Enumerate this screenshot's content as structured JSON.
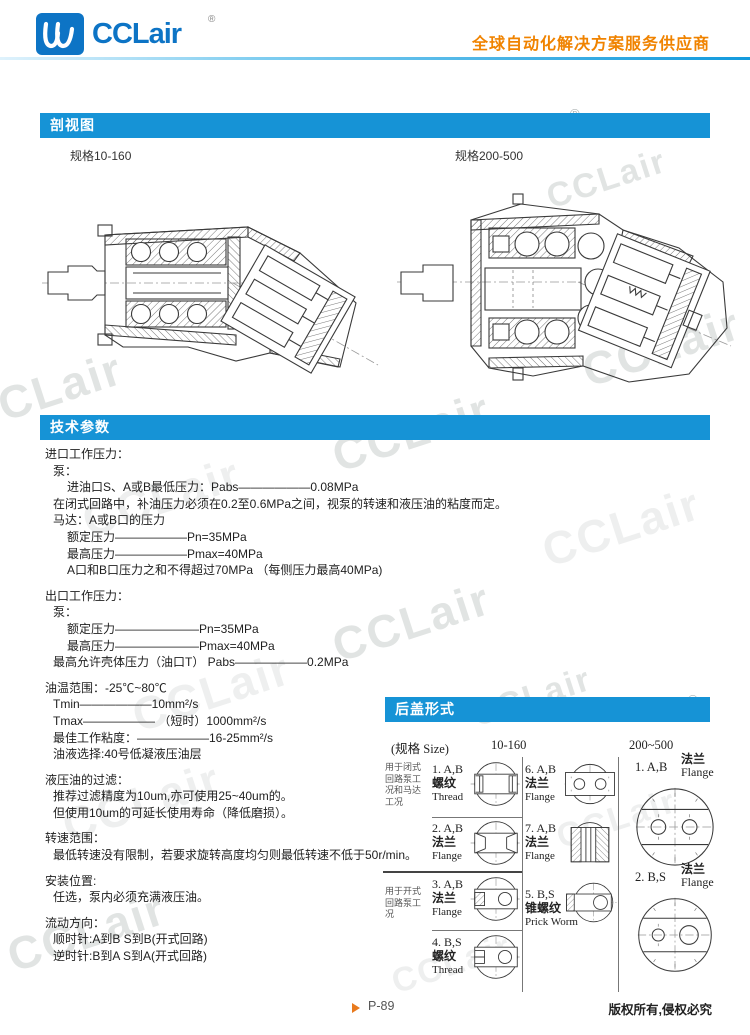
{
  "header": {
    "logo_text": "CCLair",
    "logo_reg": "®",
    "tagline": "全球自动化解决方案服务供应商"
  },
  "sections": {
    "cutaway": {
      "title": "剖视图",
      "spec_left": "规格10-160",
      "spec_right": "规格200-500"
    },
    "tech": {
      "title": "技术参数"
    },
    "rear": {
      "title": "后盖形式"
    }
  },
  "tech": {
    "lines": [
      "进口工作压力：",
      "泵：",
      "进油口S、A或B最低压力：Pabs——————0.08MPa",
      "在闭式回路中，补油压力必须在0.2至0.6MPa之间，视泵的转速和液压油的粘度而定。",
      "马达：A或B口的压力",
      "额定压力——————Pn=35MPa",
      "最高压力——————Pmax=40MPa",
      "A口和B口压力之和不得超过70MPa （每侧压力最高40MPa)",
      "出口工作压力：",
      "泵：",
      "额定压力———————Pn=35MPa",
      "最高压力———————Pmax=40MPa",
      "最高允许壳体压力（油口T） Pabs——————0.2MPa",
      "油温范围：-25℃~80℃",
      "Tmin——————10mm²/s",
      "Tmax—————— （短时）1000mm²/s",
      "最佳工作粘度：——————16-25mm²/s",
      "油液选择:40号低凝液压油层",
      "液压油的过滤：",
      "推荐过滤精度为10um,亦可使用25~40um的。",
      "但使用10um的可延长使用寿命（降低磨损）。",
      "转速范围：",
      "最低转速没有限制，若要求旋转高度均匀则最低转速不低于50r/min。",
      "安装位置:",
      "任选，泵内必须充满液压油。",
      "流动方向：",
      "顺时针:A到B S到B(开式回路)",
      "逆时针:B到A S到A(开式回路)"
    ]
  },
  "rear": {
    "header": {
      "size_label": "(规格 Size)",
      "col1": "10-160",
      "col2": "200~500"
    },
    "groups": [
      {
        "label": "用于闭式回路泵工况和马达工况"
      },
      {
        "label": "用于开式回路泵工况"
      }
    ],
    "cells": {
      "c1": {
        "num": "1. A,B",
        "cn": "螺纹",
        "en": "Thread"
      },
      "c6": {
        "num": "6. A,B",
        "cn": "法兰",
        "en": "Flange"
      },
      "c2": {
        "num": "2. A,B",
        "cn": "法兰",
        "en": "Flange"
      },
      "c7": {
        "num": "7. A,B",
        "cn": "法兰",
        "en": "Flange"
      },
      "c3": {
        "num": "3. A,B",
        "cn": "法兰",
        "en": "Flange"
      },
      "c5": {
        "num": "5. B,S",
        "cn": "锥螺纹",
        "en": "Prick Worm"
      },
      "c4": {
        "num": "4. B,S",
        "cn": "螺纹",
        "en": "Thread"
      },
      "r1": {
        "num": "1. A,B",
        "cn": "法兰",
        "en": "Flange"
      },
      "r2": {
        "num": "2. B,S",
        "cn": "法兰",
        "en": "Flange"
      }
    }
  },
  "footer": {
    "page": "P-89",
    "copyright": "版权所有,侵权必究"
  },
  "watermark": {
    "text": "CCLair",
    "reg": "®"
  }
}
